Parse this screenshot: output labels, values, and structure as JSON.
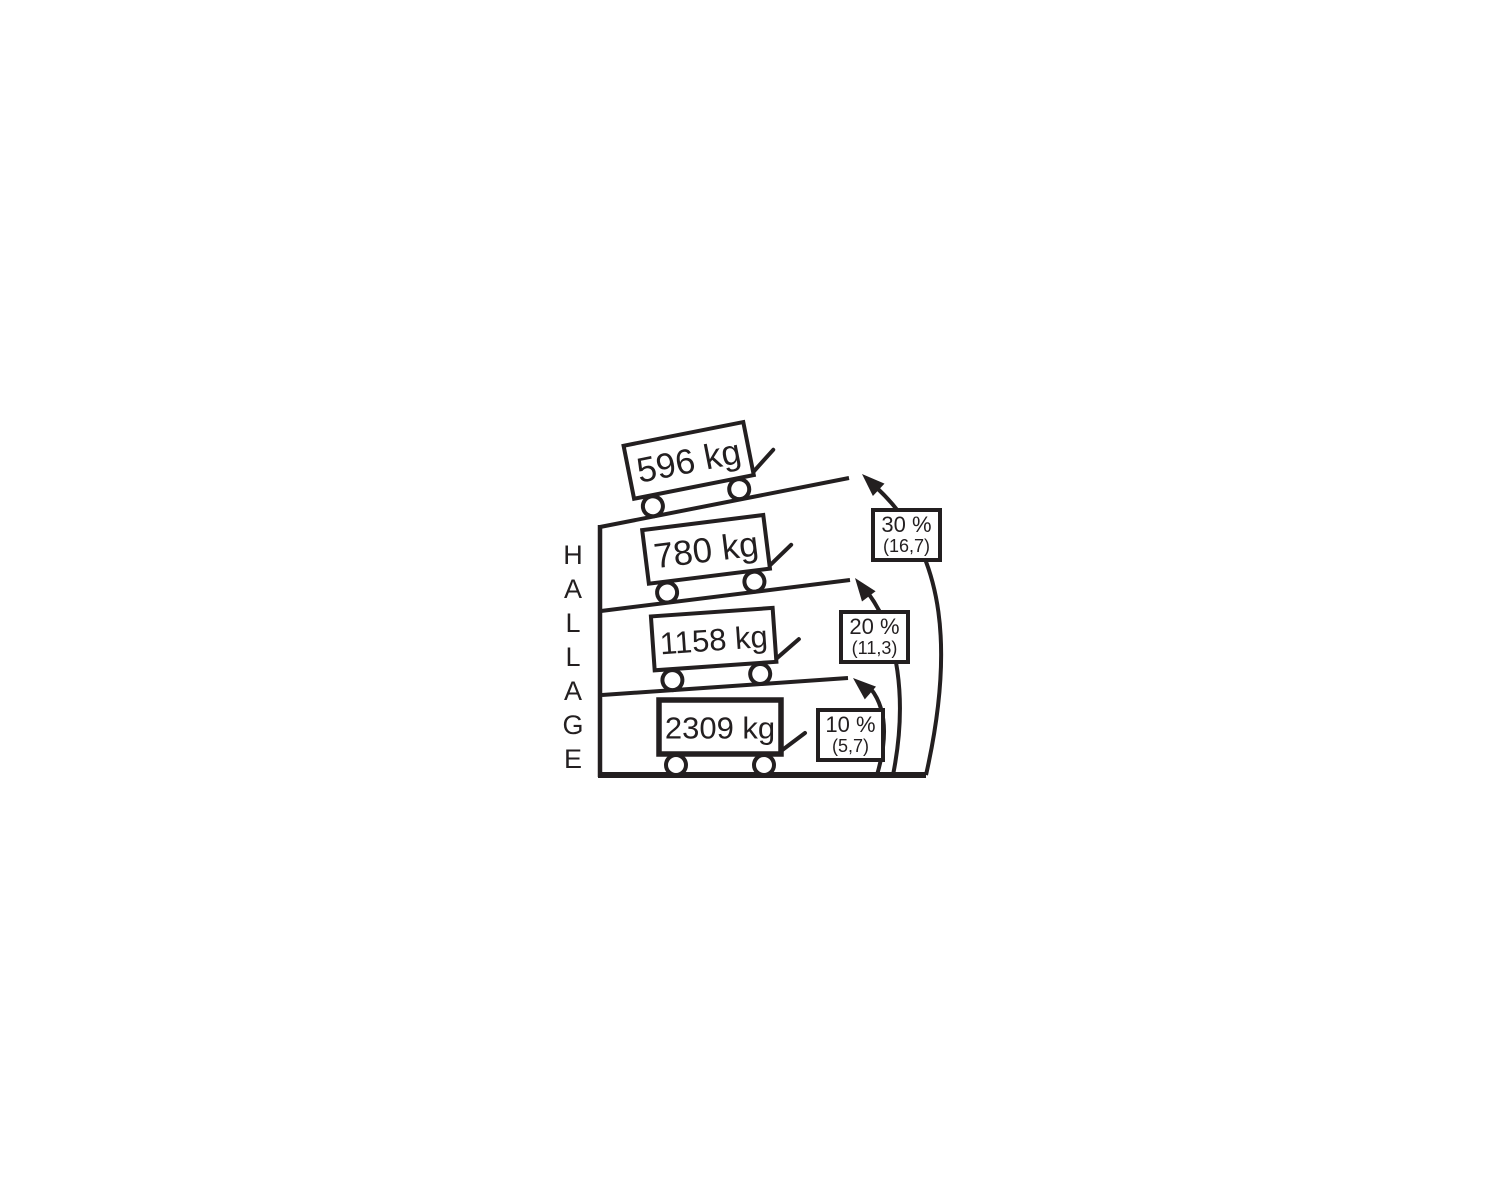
{
  "vertical_label": "HALLAGE",
  "carts": [
    {
      "weight": "596 kg",
      "incline": "30 %"
    },
    {
      "weight": "780 kg",
      "incline": "20 %"
    },
    {
      "weight": "1158 kg",
      "incline": "10 %"
    },
    {
      "weight": "2309 kg",
      "incline": "flat"
    }
  ],
  "slopes": [
    {
      "percent": "30 %",
      "angle_degrees": "(16,7)"
    },
    {
      "percent": "20 %",
      "angle_degrees": "(11,3)"
    },
    {
      "percent": "10 %",
      "angle_degrees": "(5,7)"
    }
  ],
  "colors": {
    "ink": "#231f20",
    "background": "#ffffff"
  }
}
